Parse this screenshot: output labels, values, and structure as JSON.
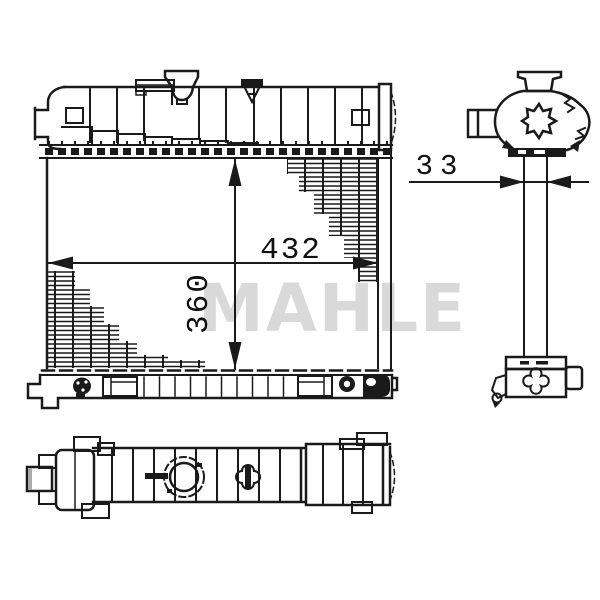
{
  "watermark": {
    "text": "MAHLE",
    "color": "#d9d9d9"
  },
  "dimensions": {
    "core_width": "432",
    "core_height": "360",
    "core_depth": "33"
  },
  "colors": {
    "line": "#1a1a1a",
    "background": "#ffffff"
  }
}
